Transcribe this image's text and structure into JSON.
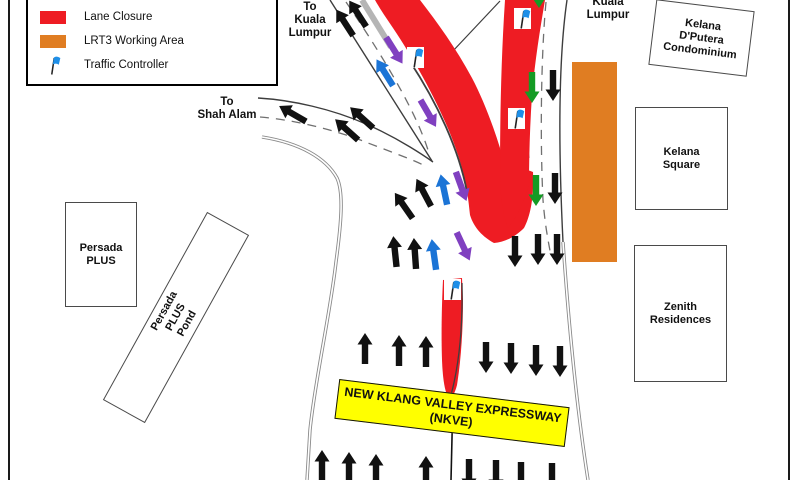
{
  "title": "NKVE Lane Closure Traffic Management Plan",
  "colors": {
    "lane_closure_red": "#ee1c23",
    "lrt3_orange": "#e07d22",
    "banner_yellow": "#ffff00",
    "flag_blue": "#1e8fe8",
    "arrow_black": "#111111",
    "arrow_blue": "#1b74d6",
    "arrow_purple": "#8040c0",
    "arrow_green": "#149b24"
  },
  "legend": {
    "items": [
      {
        "label": "Lane Closure",
        "swatch": "lane_closure_red"
      },
      {
        "label": "LRT3 Working Area",
        "swatch": "lrt3_orange"
      },
      {
        "label": "Traffic Controller",
        "swatch": "flag"
      }
    ]
  },
  "labels": {
    "to_kl_left": "To\nKuala\nLumpur",
    "to_kl_right": "Kuala\nLumpur",
    "to_shah_alam": "To\nShah Alam",
    "banner": "NEW KLANG VALLEY EXPRESSWAY\n(NKVE)"
  },
  "buildings": [
    {
      "name": "Kelana\nD'Putera\nCondominium"
    },
    {
      "name": "Kelana\nSquare"
    },
    {
      "name": "Zenith\nResidences"
    },
    {
      "name": "Persada\nPLUS"
    },
    {
      "name": "Persada PLUS\nPond"
    }
  ],
  "map": {
    "flags": [
      [
        407,
        47
      ],
      [
        514,
        8
      ],
      [
        508,
        108
      ],
      [
        444,
        279
      ]
    ],
    "arrows": [
      [
        345,
        23,
        -33,
        "black"
      ],
      [
        358,
        14,
        -33,
        "black"
      ],
      [
        394,
        50,
        148,
        "purple"
      ],
      [
        385,
        73,
        -32,
        "blue"
      ],
      [
        428,
        113,
        150,
        "purple"
      ],
      [
        293,
        114,
        -60,
        "black"
      ],
      [
        347,
        130,
        -48,
        "black"
      ],
      [
        362,
        118,
        -48,
        "black"
      ],
      [
        404,
        206,
        -35,
        "black"
      ],
      [
        424,
        193,
        -28,
        "black"
      ],
      [
        444,
        190,
        -12,
        "blue"
      ],
      [
        461,
        186,
        160,
        "purple"
      ],
      [
        395,
        252,
        -6,
        "black"
      ],
      [
        415,
        254,
        -4,
        "black"
      ],
      [
        434,
        255,
        -8,
        "blue"
      ],
      [
        463,
        246,
        155,
        "purple"
      ],
      [
        539,
        -8,
        180,
        "green"
      ],
      [
        532,
        87,
        180,
        "green"
      ],
      [
        553,
        85,
        180,
        "black"
      ],
      [
        536,
        190,
        180,
        "green"
      ],
      [
        555,
        188,
        180,
        "black"
      ],
      [
        515,
        251,
        180,
        "black"
      ],
      [
        538,
        249,
        180,
        "black"
      ],
      [
        557,
        249,
        180,
        "black"
      ],
      [
        365,
        349,
        0,
        "black"
      ],
      [
        399,
        351,
        0,
        "black"
      ],
      [
        426,
        352,
        0,
        "black"
      ],
      [
        486,
        357,
        180,
        "black"
      ],
      [
        511,
        358,
        180,
        "black"
      ],
      [
        536,
        360,
        180,
        "black"
      ],
      [
        560,
        361,
        180,
        "black"
      ],
      [
        322,
        466,
        0,
        "black"
      ],
      [
        349,
        468,
        0,
        "black"
      ],
      [
        376,
        470,
        0,
        "black"
      ],
      [
        426,
        472,
        0,
        "black"
      ],
      [
        469,
        474,
        180,
        "black"
      ],
      [
        496,
        475,
        180,
        "black"
      ],
      [
        521,
        477,
        180,
        "black"
      ],
      [
        552,
        478,
        180,
        "black"
      ]
    ]
  }
}
